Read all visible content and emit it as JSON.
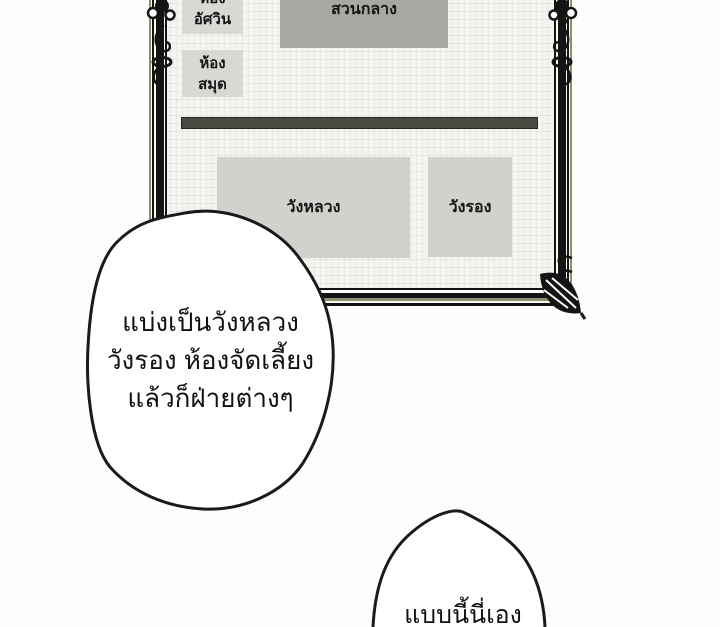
{
  "panel_type": "comic-panel",
  "map": {
    "knight_room": {
      "line1": "ห้อง",
      "line2": "อัศวิน"
    },
    "library_room": {
      "line1": "ห้อง",
      "line2": "สมุด"
    },
    "central_garden": {
      "label": "สวนกลาง"
    },
    "main_palace": {
      "label": "วังหลวง"
    },
    "secondary_palace": {
      "label": "วังรอง"
    }
  },
  "speech": {
    "main_bubble": {
      "line1": "แบ่งเป็นวังหลวง",
      "line2": "วังรอง ห้องจัดเลี้ยง",
      "line3": "แล้วก็ฝ่ายต่างๆ"
    },
    "bottom_bubble": {
      "line1": "แบบนี้นี่เอง"
    }
  },
  "colors": {
    "paper_texture": "#f5f4f0",
    "room_gray": "#d9d8d5",
    "garden_gray": "#a9a7a2",
    "palace_gray": "#d2d1ce",
    "divider_dark": "#4b4a42",
    "frame_black": "#141414",
    "frame_tan": "#8e8e6e",
    "background": "#fdfdfc",
    "ink": "#111111"
  }
}
